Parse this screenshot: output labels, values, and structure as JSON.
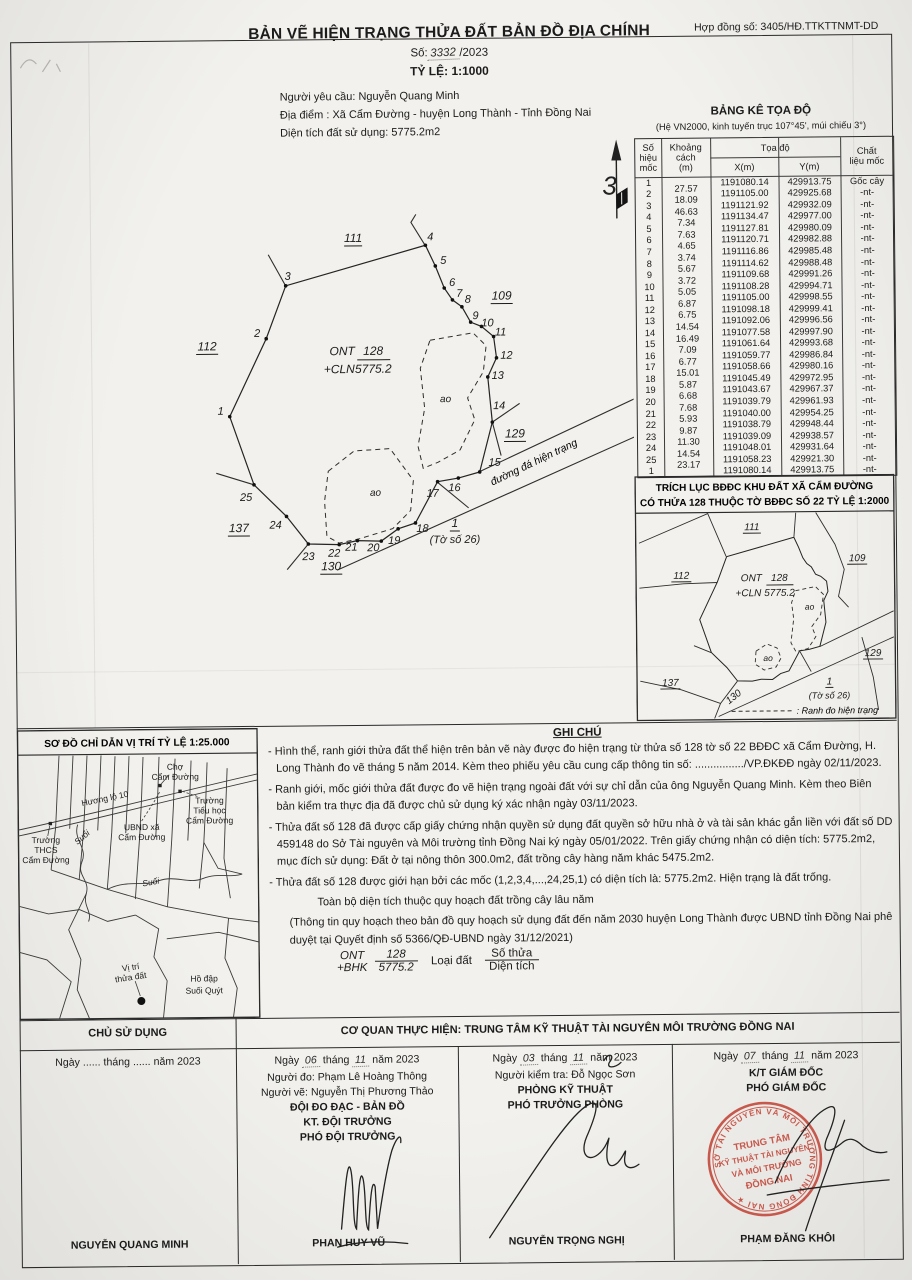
{
  "header": {
    "title": "BẢN VẼ HIỆN TRẠNG THỬA ĐẤT BẢN ĐỒ ĐỊA CHÍNH",
    "contract": "Hợp đồng số: 3405/HĐ.TTKTTNMT-DD",
    "so_prefix": "Số:",
    "so_value": "3332",
    "so_suffix": "/2023",
    "scale": "TỶ LỆ: 1:1000",
    "requester": "Người yêu cầu: Nguyễn Quang Minh",
    "address": "Địa điểm : Xã Cẩm Đường - huyện Long Thành - Tỉnh Đồng Nai",
    "area": "Diện tích đất sử dụng: 5775.2m2"
  },
  "coord_table": {
    "title": "BẢNG KÊ TỌA ĐỘ",
    "subtitle": "(Hệ VN2000, kinh tuyến trục 107°45', múi chiếu 3°)",
    "headers": {
      "id": "Số hiệu mốc",
      "dist": "Khoảng cách (m)",
      "coord": "Tọa độ",
      "x": "X(m)",
      "y": "Y(m)",
      "mat": "Chất liệu mốc"
    },
    "points": [
      {
        "id": "1",
        "dist": "",
        "x": "1191080.14",
        "y": "429913.75",
        "mat": "Gốc cây"
      },
      {
        "id": "2",
        "dist": "27.57",
        "x": "1191105.00",
        "y": "429925.68",
        "mat": "-nt-"
      },
      {
        "id": "3",
        "dist": "18.09",
        "x": "1191121.92",
        "y": "429932.09",
        "mat": "-nt-"
      },
      {
        "id": "4",
        "dist": "46.63",
        "x": "1191134.47",
        "y": "429977.00",
        "mat": "-nt-"
      },
      {
        "id": "5",
        "dist": "7.34",
        "x": "1191127.81",
        "y": "429980.09",
        "mat": "-nt-"
      },
      {
        "id": "6",
        "dist": "7.63",
        "x": "1191120.71",
        "y": "429982.88",
        "mat": "-nt-"
      },
      {
        "id": "7",
        "dist": "4.65",
        "x": "1191116.86",
        "y": "429985.48",
        "mat": "-nt-"
      },
      {
        "id": "8",
        "dist": "3.74",
        "x": "1191114.62",
        "y": "429988.48",
        "mat": "-nt-"
      },
      {
        "id": "9",
        "dist": "5.67",
        "x": "1191109.68",
        "y": "429991.26",
        "mat": "-nt-"
      },
      {
        "id": "10",
        "dist": "3.72",
        "x": "1191108.28",
        "y": "429994.71",
        "mat": "-nt-"
      },
      {
        "id": "11",
        "dist": "5.05",
        "x": "1191105.00",
        "y": "429998.55",
        "mat": "-nt-"
      },
      {
        "id": "12",
        "dist": "6.87",
        "x": "1191098.18",
        "y": "429999.41",
        "mat": "-nt-"
      },
      {
        "id": "13",
        "dist": "6.75",
        "x": "1191092.06",
        "y": "429996.56",
        "mat": "-nt-"
      },
      {
        "id": "14",
        "dist": "14.54",
        "x": "1191077.58",
        "y": "429997.90",
        "mat": "-nt-"
      },
      {
        "id": "15",
        "dist": "16.49",
        "x": "1191061.64",
        "y": "429993.68",
        "mat": "-nt-"
      },
      {
        "id": "16",
        "dist": "7.09",
        "x": "1191059.77",
        "y": "429986.84",
        "mat": "-nt-"
      },
      {
        "id": "17",
        "dist": "6.77",
        "x": "1191058.66",
        "y": "429980.16",
        "mat": "-nt-"
      },
      {
        "id": "18",
        "dist": "15.01",
        "x": "1191045.49",
        "y": "429972.95",
        "mat": "-nt-"
      },
      {
        "id": "19",
        "dist": "5.87",
        "x": "1191043.67",
        "y": "429967.37",
        "mat": "-nt-"
      },
      {
        "id": "20",
        "dist": "6.68",
        "x": "1191039.79",
        "y": "429961.93",
        "mat": "-nt-"
      },
      {
        "id": "21",
        "dist": "7.68",
        "x": "1191040.00",
        "y": "429954.25",
        "mat": "-nt-"
      },
      {
        "id": "22",
        "dist": "5.93",
        "x": "1191038.79",
        "y": "429948.44",
        "mat": "-nt-"
      },
      {
        "id": "23",
        "dist": "9.87",
        "x": "1191039.09",
        "y": "429938.57",
        "mat": "-nt-"
      },
      {
        "id": "24",
        "dist": "11.30",
        "x": "1191048.01",
        "y": "429931.64",
        "mat": "-nt-"
      },
      {
        "id": "25",
        "dist": "14.54",
        "x": "1191058.23",
        "y": "429921.30",
        "mat": "-nt-"
      },
      {
        "id": "1",
        "dist": "23.17",
        "x": "1191080.14",
        "y": "429913.75",
        "mat": "-nt-"
      }
    ]
  },
  "main_map": {
    "north_mark": "3",
    "parcel_type": "ONT",
    "parcel_num": "128",
    "parcel_type2": "+CLN",
    "parcel_area": "5775.2",
    "pond_label": "ao",
    "road_label": "đường đá hiện trạng",
    "sheet_num": "1",
    "sheet_note": "(Tờ số 26)",
    "neighbors": {
      "n111": "111",
      "n112": "112",
      "n109": "109",
      "n129": "129",
      "n137": "137",
      "n130": "130"
    }
  },
  "extract_map": {
    "title1": "TRÍCH LỤC BĐĐC KHU ĐẤT XÃ CẨM ĐƯỜNG",
    "title2": "CÓ THỬA 128 THUỘC TỜ BĐĐC SỐ 22 TỶ LỆ 1:2000",
    "parcel_type": "ONT",
    "parcel_num": "128",
    "parcel_type2": "+CLN",
    "parcel_area": "5775.2",
    "pond_label": "ao",
    "sheet_num": "1",
    "sheet_note": "(Tờ số 26)",
    "legend_text": ": Ranh đo hiện trạng",
    "neighbors": {
      "n111": "111",
      "n112": "112",
      "n109": "109",
      "n129": "129",
      "n137": "137",
      "n130": "130"
    }
  },
  "sketch_map": {
    "title": "SƠ ĐỒ CHỈ DẪN VỊ TRÍ TỶ LỆ 1:25.000",
    "labels": {
      "cho1": "Chợ",
      "cho2": "Cẩm Đường",
      "huong_lo": "Hương lộ 10",
      "th1": "Trường",
      "th2": "Tiểu học",
      "th3": "Cẩm Đường",
      "ubnd1": "UBND xã",
      "ubnd2": "Cẩm Đường",
      "thcs1": "Trường",
      "thcs2": "THCS",
      "thcs3": "Cẩm Đường",
      "suoi": "Suối",
      "vitri1": "Vị trí",
      "vitri2": "thửa đất",
      "hodap1": "Hồ đập",
      "hodap2": "Suối Quýt"
    }
  },
  "notes": {
    "title": "GHI CHÚ",
    "items": [
      {
        "text": "- Hình thể, ranh giới thửa đất thể hiện trên bản vẽ này được đo hiện trạng từ thửa số 128 tờ số 22 BĐĐC xã Cẩm Đường, H. Long Thành đo vẽ tháng 5 năm 2014. Kèm theo phiếu yêu cầu cung cấp thông tin số: ................/VP.ĐKĐĐ ngày 02/11/2023.",
        "style": "normal"
      },
      {
        "text": "- Ranh giới, mốc giới thửa đất được đo vẽ hiện trạng ngoài đất với sự chỉ dẫn của ông Nguyễn Quang Minh. Kèm theo Biên bản kiểm tra thực địa đã được chủ sử dụng ký xác nhận ngày 03/11/2023.",
        "style": "normal"
      },
      {
        "text": "- Thửa đất số 128 đã được cấp giấy chứng nhận quyền sử dụng đất quyền sở hữu nhà ở và tài sản khác gắn liền với đất số DD 459148 do Sở Tài nguyên và Môi trường tỉnh Đồng Nai ký ngày 05/01/2022. Trên giấy chứng nhận có diện tích: 5775.2m2, mục đích sử dụng: Đất ở tại nông thôn 300.0m2, đất trồng cây hàng năm khác 5475.2m2.",
        "style": "normal"
      },
      {
        "text": "- Thửa đất số 128 được giới hạn bởi các mốc (1,2,3,4,...,24,25,1) có diện tích là: 5775.2m2. Hiện trạng là đất trống.",
        "style": "normal"
      },
      {
        "text": "Toàn bộ diện tích thuộc quy hoạch đất trồng cây lâu năm",
        "style": "indent"
      },
      {
        "text": "(Thông tin quy hoạch theo bản đồ quy hoạch sử dụng đất đến năm 2030 huyện Long Thành được UBND tỉnh Đồng Nai phê duyệt tại Quyết định số 5366/QĐ-UBND ngày 31/12/2021)",
        "style": "small"
      }
    ],
    "formula": {
      "type_top": "ONT",
      "num_top": "128",
      "type_bot": "+BHK",
      "area_bot": "5775.2",
      "label_mid": "Loại đất",
      "frac_top": "Số thửa",
      "frac_bot": "Diện tích"
    }
  },
  "footer": {
    "header_left": "CHỦ SỬ DỤNG",
    "header_right": "CƠ QUAN THỰC HIỆN: TRUNG TÂM KỸ THUẬT TÀI NGUYÊN MÔI TRƯỜNG ĐỒNG NAI",
    "cols": [
      {
        "day": "......",
        "month": "......",
        "year": "năm 2023",
        "hand": false,
        "lines": [],
        "name": "NGUYỄN QUANG MINH"
      },
      {
        "day": "06",
        "month": "11",
        "year": "năm 2023",
        "hand": true,
        "lines": [
          "Người đo: Phạm Lê Hoàng Thông",
          "Người vẽ: Nguyễn Thị Phương Thảo",
          "ĐỘI ĐO ĐẠC - BẢN ĐỒ",
          "KT. ĐỘI TRƯỞNG",
          "PHÓ ĐỘI TRƯỞNG"
        ],
        "bold_from": 2,
        "name": "PHAN HUY VŨ"
      },
      {
        "day": "03",
        "month": "11",
        "year": "năm 2023",
        "hand": true,
        "lines": [
          "Người kiểm tra: Đỗ Ngọc Sơn",
          "PHÒNG KỸ THUẬT",
          "PHÓ TRƯỞNG PHÒNG"
        ],
        "bold_from": 1,
        "name": "NGUYỄN TRỌNG NGHỊ"
      },
      {
        "day": "07",
        "month": "11",
        "year": "năm 2023",
        "hand": true,
        "lines": [
          "K/T GIÁM ĐỐC",
          "PHÓ GIÁM ĐỐC"
        ],
        "bold_from": 0,
        "name": "PHẠM ĐĂNG KHÔI"
      }
    ],
    "stamp": {
      "ring_text": "SỞ TÀI NGUYÊN VÀ MÔI TRƯỜNG TỈNH ĐỒNG NAI ★",
      "line1": "TRUNG TÂM",
      "line2": "KỸ THUẬT TÀI NGUYÊN",
      "line3": "VÀ MÔI TRƯỜNG",
      "line4": "ĐỒNG NAI",
      "color": "#c0392b"
    }
  }
}
